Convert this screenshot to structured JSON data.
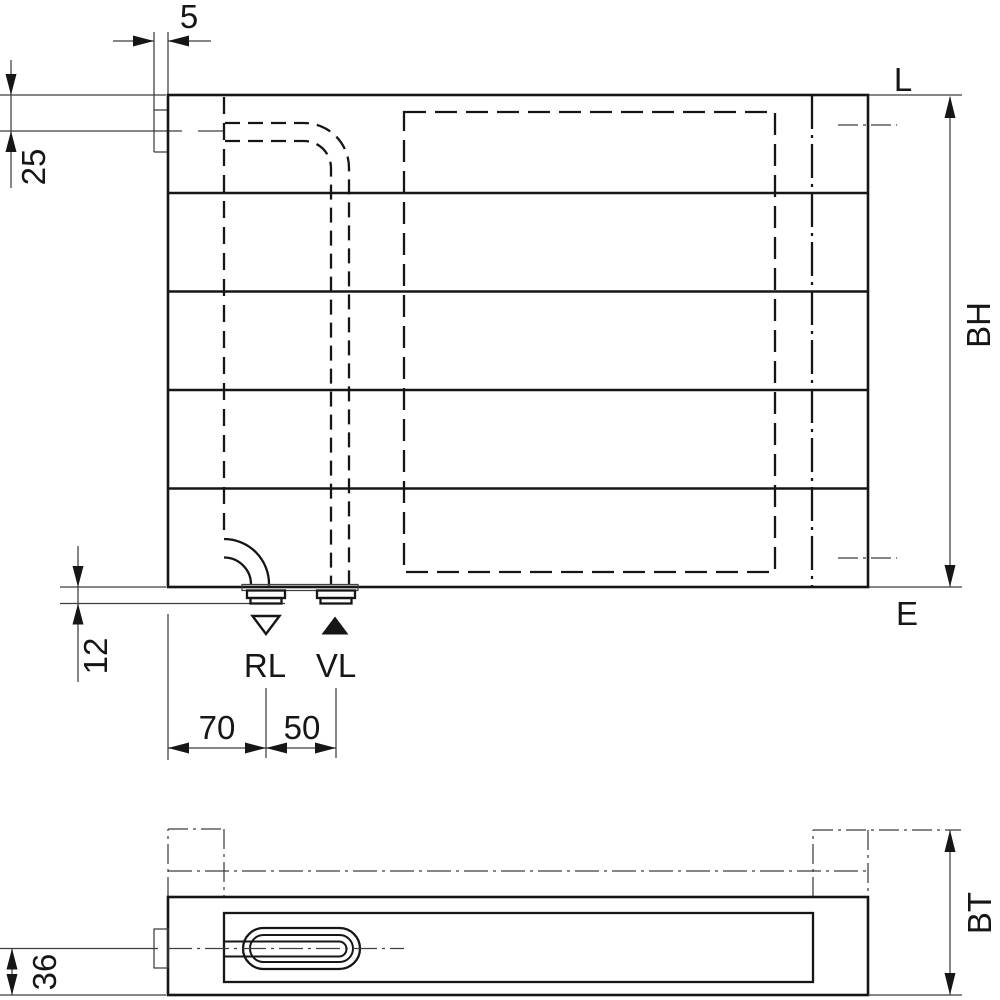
{
  "front_view": {
    "wall_bracket_dim": "5",
    "top_to_pipe_center_dim": "25",
    "length_ref_label": "L",
    "height_dim_label": "BH",
    "bottom_ref_label": "E",
    "connection_height_dim": "12",
    "return_label": "RL",
    "supply_label": "VL",
    "return_symbol": "open-triangle-down",
    "supply_symbol": "filled-triangle-up",
    "edge_to_return_dim": "70",
    "return_to_supply_dim": "50"
  },
  "plan_view": {
    "depth_dim_label": "BT",
    "center_to_front_dim": "36"
  },
  "colors": {
    "outline": "#161616",
    "thin_line": "#3f3f3f",
    "background": "#ffffff"
  }
}
